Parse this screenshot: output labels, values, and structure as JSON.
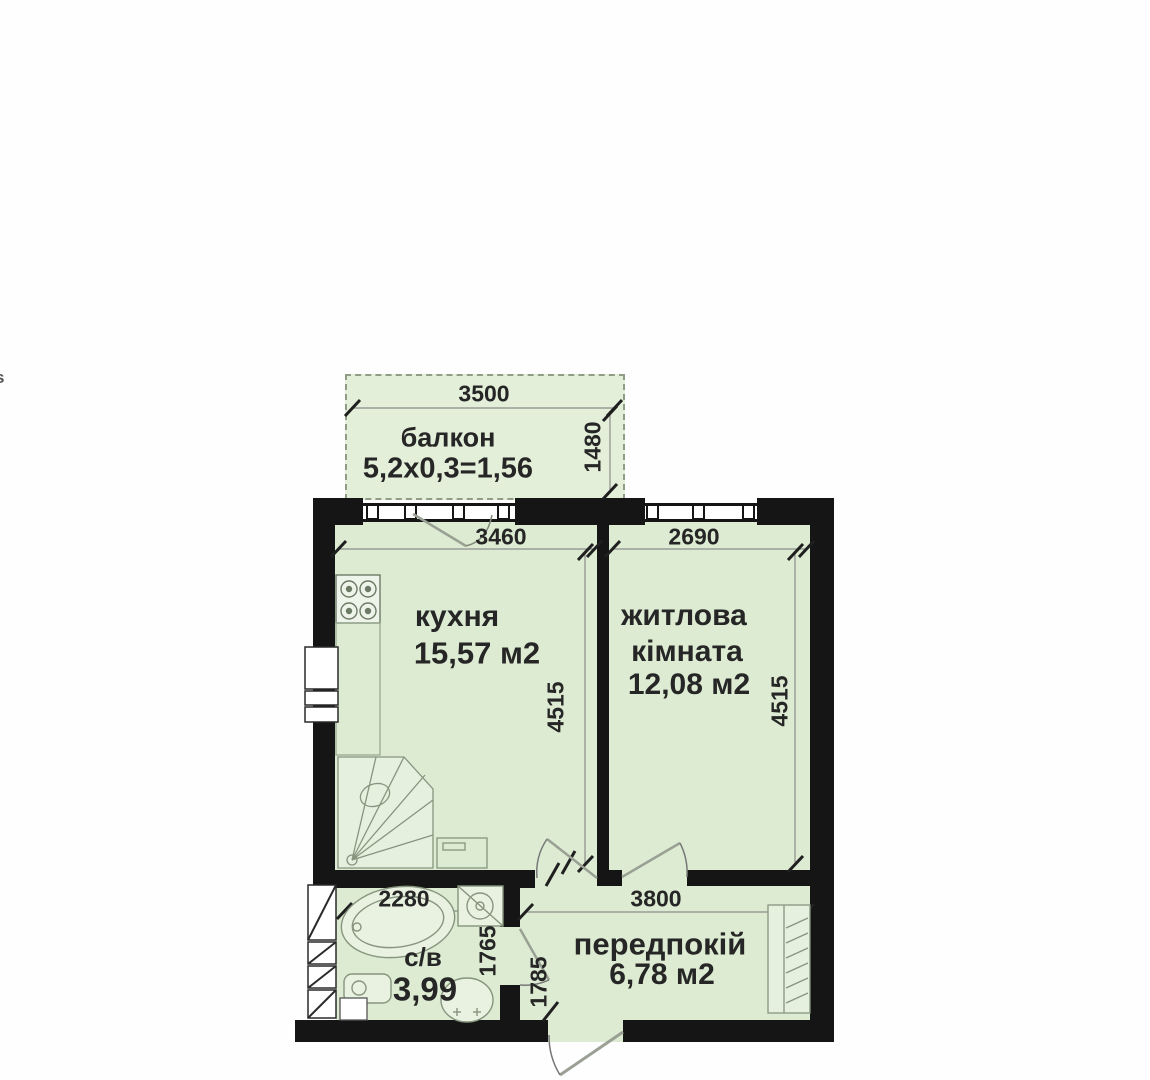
{
  "artifact": {
    "edge_text": "s"
  },
  "colors": {
    "wall": "#151515",
    "room_fill": "#dcebd2",
    "balcony_fill": "#e3efd9",
    "fixture_stroke": "#87957e",
    "dim_text": "#262626"
  },
  "floorplan": {
    "balcony": {
      "label": "балкон",
      "formula": "5,2х0,3=1,56",
      "dim_width": "3500",
      "dim_depth": "1480"
    },
    "kitchen": {
      "label": "кухня",
      "area": "15,57 м2",
      "dim_width": "3460",
      "dim_height": "4515"
    },
    "living_room": {
      "label_line1": "житлова",
      "label_line2": "кімната",
      "area": "12,08 м2",
      "dim_width": "2690",
      "dim_height": "4515"
    },
    "bathroom": {
      "label": "с/в",
      "area": "3,99",
      "dim_width": "2280",
      "dim_height": "1765"
    },
    "hallway": {
      "label": "передпокій",
      "area": "6,78 м2",
      "dim_width": "3800",
      "dim_height": "1785"
    }
  }
}
